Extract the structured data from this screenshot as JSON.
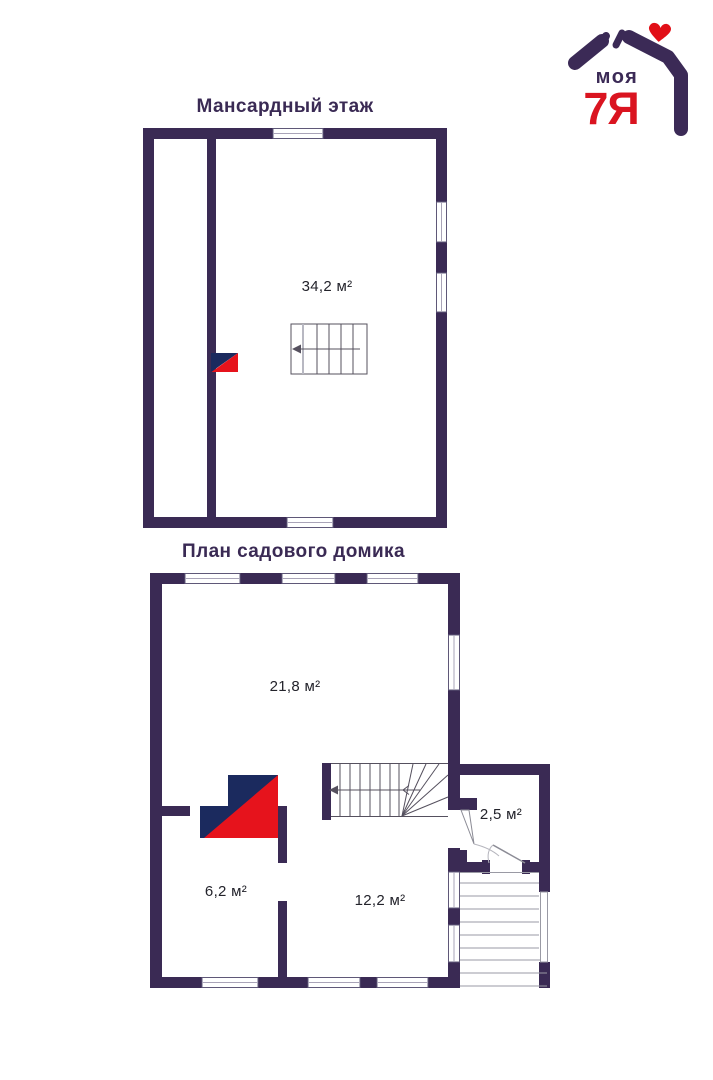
{
  "logo": {
    "word": "моя",
    "family": "7Я"
  },
  "plans": {
    "attic": {
      "title": "Мансардный этаж",
      "rooms": {
        "main": "34,2 м²"
      }
    },
    "ground": {
      "title": "План садового домика",
      "rooms": {
        "living": "21,8 м²",
        "entry": "2,5 м²",
        "left": "6,2 м²",
        "right": "12,2 м²"
      }
    }
  },
  "colors": {
    "wall": "#3a2a54",
    "brand_navy": "#1b2a5e",
    "brand_red": "#e6131c",
    "background": "#ffffff"
  }
}
